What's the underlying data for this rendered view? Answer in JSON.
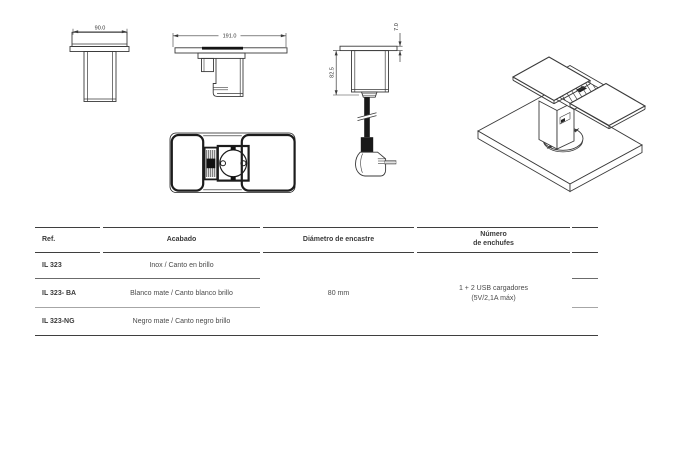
{
  "meta": {
    "background": "#ffffff",
    "line_color": "#3a3a3a"
  },
  "drawings": {
    "front_view": {
      "width_dim": "90.0"
    },
    "section_view": {
      "width_dim": "191.0"
    },
    "profile_view": {
      "thickness_dim": "7.0",
      "height_dim": "82.5"
    },
    "isometric_view": {
      "hole_dim": "ø80"
    }
  },
  "spec_table": {
    "headers": {
      "ref": "Ref.",
      "finish": "Acabado",
      "diameter": "Diámetro de encastre",
      "sockets_line1": "Número",
      "sockets_line2": "de enchufes"
    },
    "rows": [
      {
        "ref": "IL 323",
        "finish": "Inox / Canto en brillo"
      },
      {
        "ref": "IL 323- BA",
        "finish": "Blanco mate / Canto blanco brillo"
      },
      {
        "ref": "IL 323-NG",
        "finish": "Negro mate / Canto negro brillo"
      }
    ],
    "merged": {
      "diameter_value": "80 mm",
      "sockets_line1": "1 + 2 USB cargadores",
      "sockets_line2": "(5V/2,1A máx)"
    }
  }
}
